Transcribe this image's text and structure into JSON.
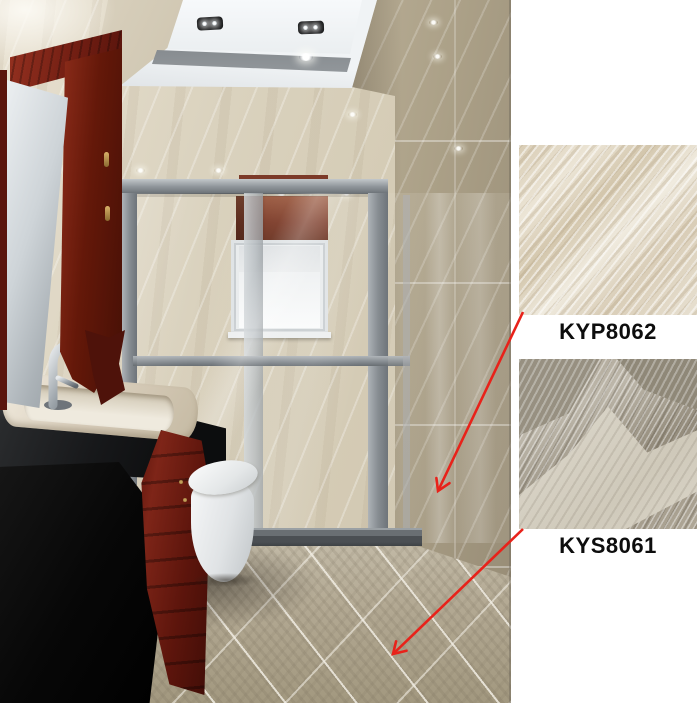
{
  "image": {
    "width": 700,
    "height": 703,
    "description": "Bathroom interior 3D render with two ceramic tile product samples annotated by red arrows"
  },
  "panel": {
    "background": "#ffffff",
    "annotation_arrow_color": "#e8221a",
    "samples": [
      {
        "code": "KYP8062",
        "applied_to": "wall",
        "swatch_base_color": "#e4dcc9"
      },
      {
        "code": "KYS8061",
        "applied_to": "floor",
        "swatch_base_color": "#aca392"
      }
    ]
  },
  "annotations": {
    "arrows": [
      {
        "x1": 523,
        "y1": 312,
        "x2": 438,
        "y2": 491
      },
      {
        "x1": 523,
        "y1": 529,
        "x2": 393,
        "y2": 654
      }
    ]
  },
  "scene_palette": {
    "wall_tile": "#d5ccb8",
    "floor_tile": "#b2a893",
    "wood_cabinet": "#6b1c10",
    "shower_frame": "#8f959a",
    "countertop": "#141517",
    "ceiling": "#eef1f3",
    "toilet": "#f4f5f6"
  }
}
